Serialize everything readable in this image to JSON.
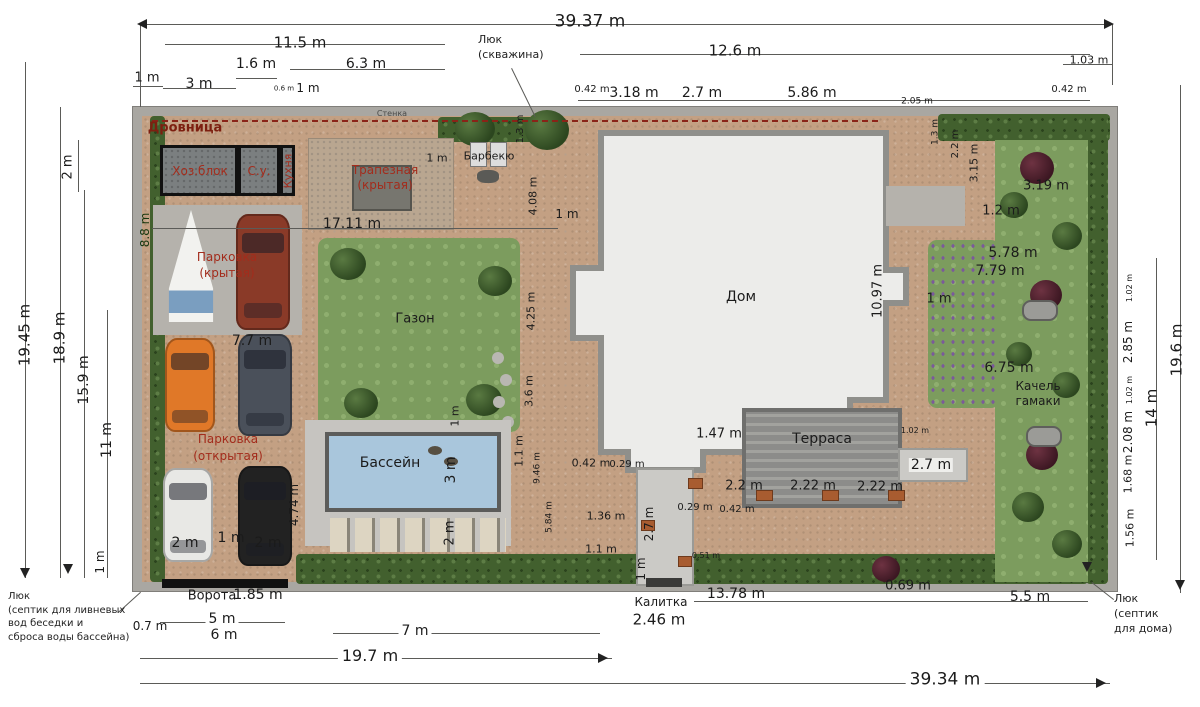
{
  "colors": {
    "accent_red": "#a32c1c",
    "paving": "#c3a083",
    "lawn": "#7c9c5e",
    "pool": "#a9c6dc",
    "house": "#ececea",
    "fence": "#a9a7a2",
    "hedge": "#42602e"
  },
  "areas": {
    "drovnitsa": "Дровница",
    "hozblok": "Хоз.блок",
    "su": "С.у.",
    "kuhnya": "Кухня",
    "trapeznaya1": "Трапезная",
    "trapeznaya2": "(крытая)",
    "barbekyu": "Барбекю",
    "parking_cov1": "Парковка",
    "parking_cov2": "(крытая)",
    "gazon": "Газон",
    "parking_open1": "Парковка",
    "parking_open2": "(открытая)",
    "bassein": "Бассейн",
    "dom": "Дом",
    "terrasa": "Терраса",
    "kachel1": "Качель",
    "kachel2": "гамаки",
    "vorota": "Ворота",
    "kalitka": "Калитка",
    "stenka": "Стенка"
  },
  "luk_top": [
    "Люк",
    "(скважина)"
  ],
  "luk_bl": [
    "Люк",
    "(септик для ливневых",
    "вод беседки и",
    "сброса воды бассейна)"
  ],
  "luk_br": [
    "Люк",
    "(септик",
    "для дома)"
  ],
  "dims": {
    "top_total": "39.37 m",
    "top_11_5": "11.5 m",
    "top_12_6": "12.6 m",
    "top_1_03": "1.03 m",
    "top_1_6": "1.6 m",
    "top_6_3": "6.3 m",
    "top_1m_left": "1 m",
    "top_3m": "3 m",
    "top_0_6": "0.6 m",
    "top_1m_mid": "1 m",
    "top_0_42_l": "0.42 m",
    "top_3_18": "3.18 m",
    "top_2_7": "2.7 m",
    "top_5_86": "5.86 m",
    "top_0_42_r": "0.42 m",
    "top_2_05": "2.05 m",
    "left_19_45": "19.45 m",
    "left_18_9": "18.9 m",
    "left_15_9": "15.9 m",
    "left_11": "11 m",
    "left_2": "2 m",
    "left_1": "1 m",
    "left_8_8": "8.8 m",
    "right_19_6": "19.6 m",
    "right_14": "14 m",
    "right_1_02a": "1.02 m",
    "right_2_85": "2.85 m",
    "right_1_02b": "1.02 m",
    "right_2_08": "2.08 m",
    "right_1_68": "1.68 m",
    "right_1_56": "1.56 m",
    "bot_total": "39.34 m",
    "bot_19_7": "19.7 m",
    "bot_7": "7 m",
    "bot_5": "5 m",
    "bot_6": "6 m",
    "bot_0_7": "0.7 m",
    "bot_1_85": "1.85 m",
    "bot_2_46": "2.46 m",
    "bot_13_78": "13.78 m",
    "bot_0_69": "0.69 m",
    "bot_5_5": "5.5 m",
    "in_17_11": "17.11 m",
    "in_1m_trap": "1 m",
    "in_1_3": "1.3 m",
    "in_4_08": "4.08 m",
    "in_1m_house": "1 m",
    "in_4_25": "4.25 m",
    "in_3_6": "3.6 m",
    "in_7_7": "7.7 m",
    "in_2m_a": "2 m",
    "in_1m_park": "1 m",
    "in_2m_b": "2 m",
    "in_4_74": "4.74 m",
    "in_1m_pool": "1 m",
    "in_3m_pool": "3 m",
    "in_2m_loung": "2 m",
    "in_1_1_pool": "1.1 m",
    "in_9_46": "9.46 m",
    "in_5_84": "5.84 m",
    "in_10_97": "10.97 m",
    "in_1_47": "1.47 m",
    "in_2_2_terr": "2.2 m",
    "in_2_22a": "2.22 m",
    "in_2_22b": "2.22 m",
    "in_2_7_porch": "2.7 m",
    "in_1_02": "1.02 m",
    "in_0_42a": "0.42 m",
    "in_0_29a": "0.29 m",
    "in_1_36": "1.36 m",
    "in_1_1_path": "1.1 m",
    "in_2_7_path": "2.7 m",
    "in_1m_path": "1 m",
    "in_0_29b": "0.29 m",
    "in_0_42b": "0.42 m",
    "in_0_51": "0.51 m",
    "in_5_78": "5.78 m",
    "in_7_79": "7.79 m",
    "in_1m_right": "1 m",
    "in_6_75": "6.75 m",
    "in_3_19": "3.19 m",
    "in_1_2": "1.2 m",
    "tr_1_3": "1.3 m",
    "tr_2_2": "2.2 m",
    "tr_3_15": "3.15 m"
  }
}
